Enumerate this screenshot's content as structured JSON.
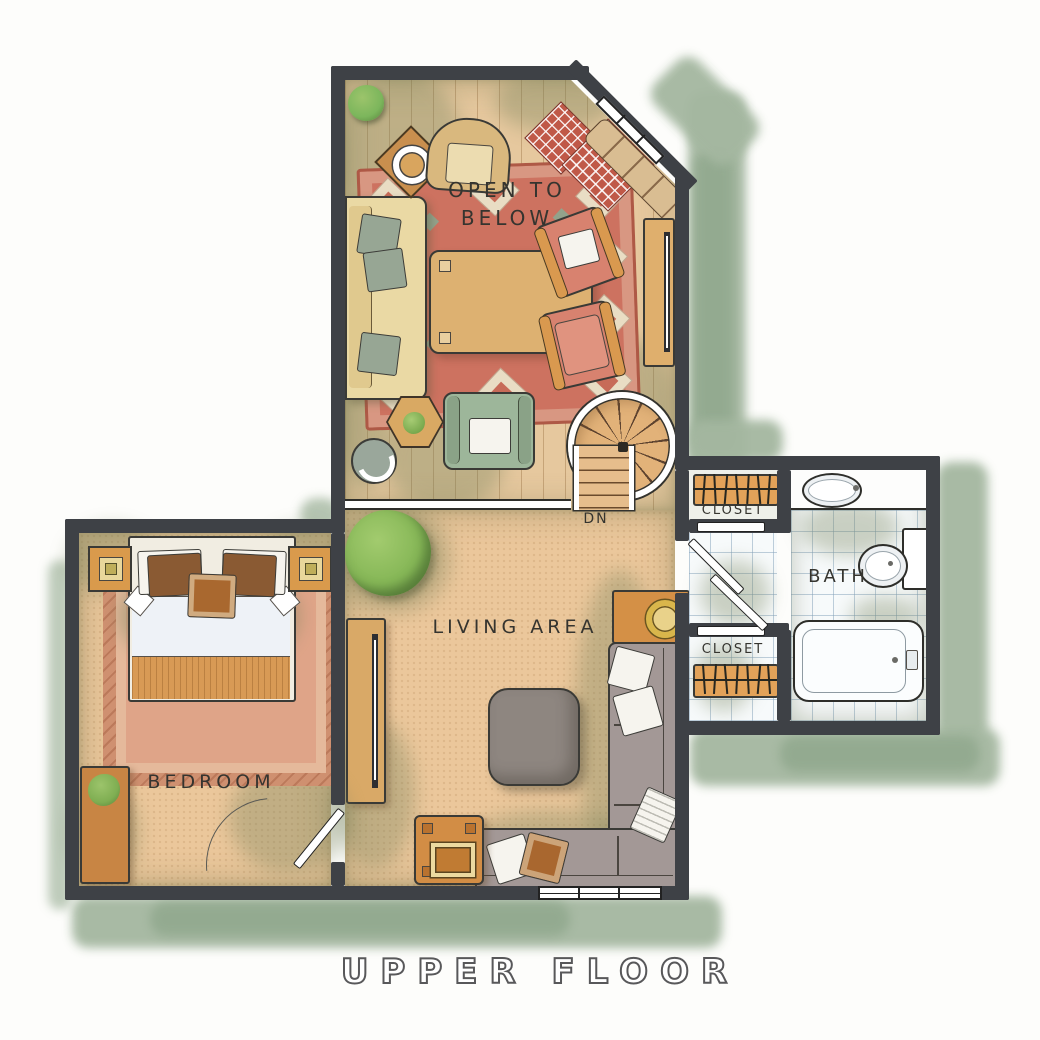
{
  "labels": {
    "open_to_below_line1": "OPEN TO",
    "open_to_below_line2": "BELOW",
    "living_area": "LIVING AREA",
    "bedroom": "BEDROOM",
    "bath": "BATH",
    "closet_top": "CLOSET",
    "closet_bottom": "CLOSET",
    "stairs_dn": "DN",
    "title": "UPPER FLOOR"
  },
  "colors": {
    "wall": "#3e4146",
    "outer_shadow_sage": "#a4b7a0",
    "carpet": "#ebc79b",
    "wood_floor": "#e6c89e",
    "main_rug_red": "#cd7260",
    "bedroom_rug_salmon": "#dfa488",
    "sectional_gray": "#a39896",
    "accent_wood": "#d49046",
    "bath_tile": "#f7fafb",
    "plant_green": "#86b757",
    "armchair_coral": "#d8826f",
    "armchair_green": "#9db69a"
  }
}
